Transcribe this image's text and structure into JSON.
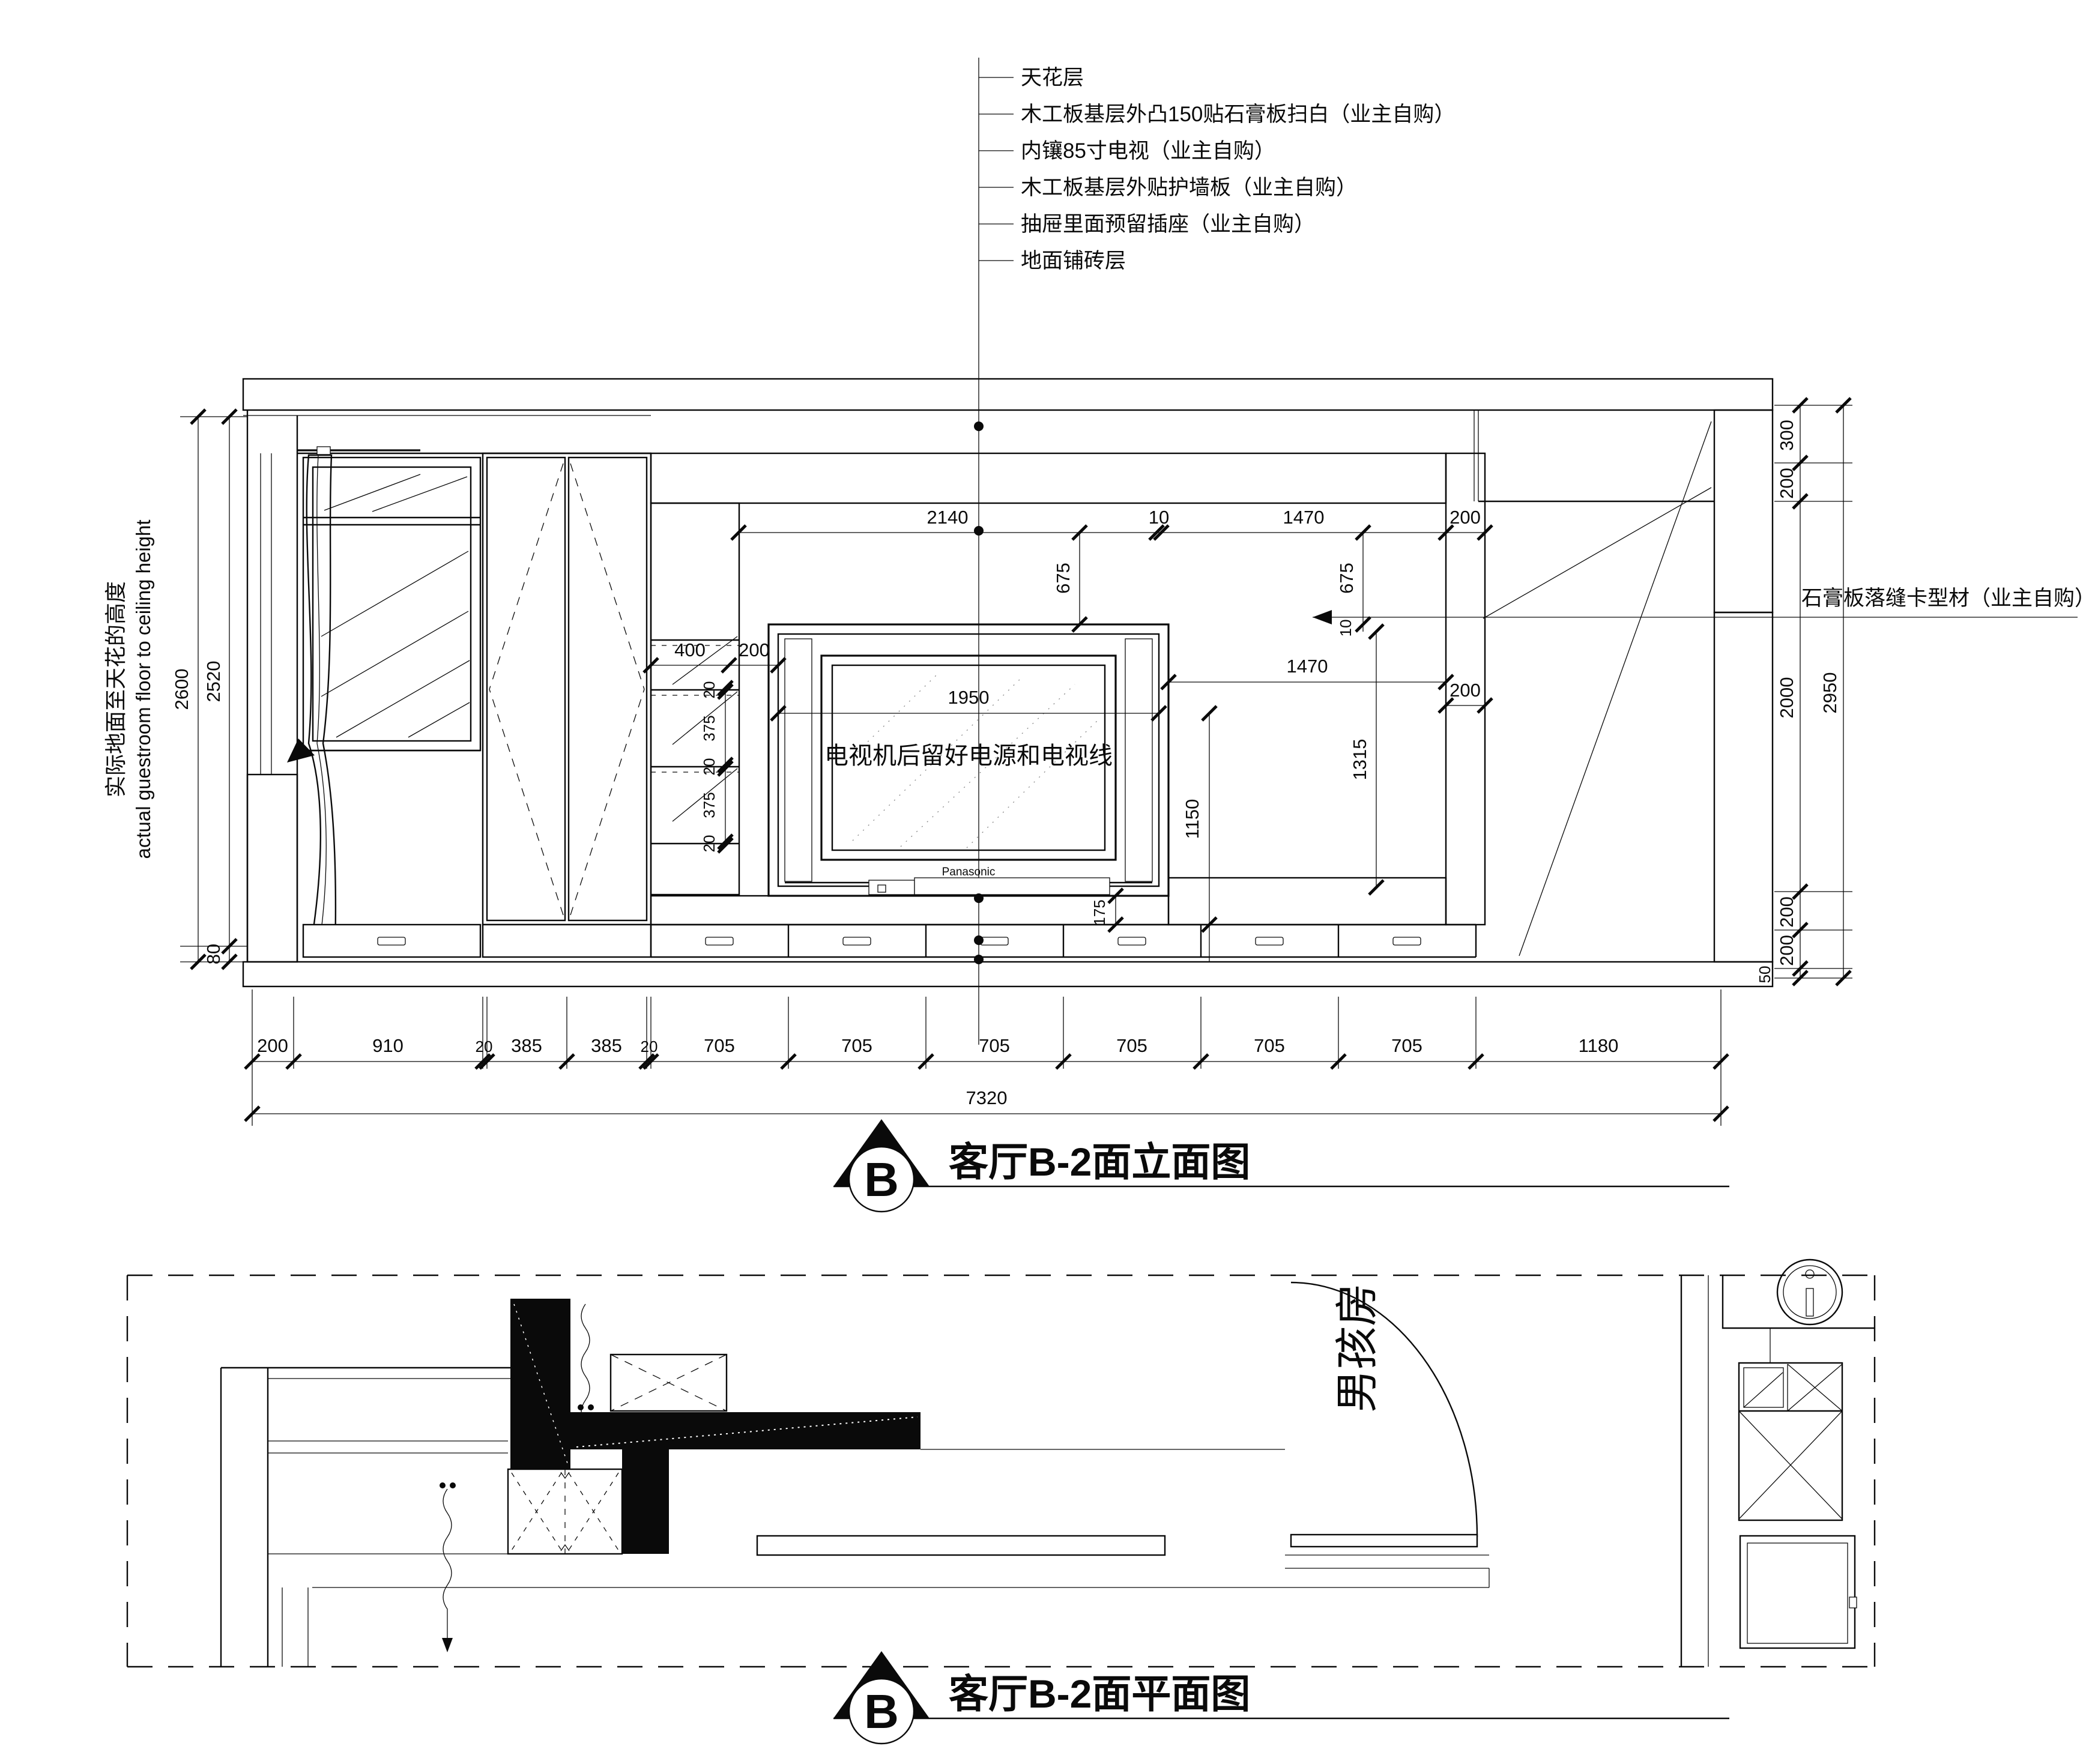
{
  "callouts": {
    "items": [
      "天花层",
      "木工板基层外凸150贴石膏板扫白（业主自购）",
      "内镶85寸电视（业主自购）",
      "木工板基层外贴护墙板（业主自购）",
      "抽屉里面预留插座（业主自购）",
      "地面铺砖层"
    ]
  },
  "right_callout": "石膏板落缝卡型材（业主自购）",
  "side_note": {
    "cn": "实际地面至天花的高度",
    "en": "actual guestroom floor to ceiling height"
  },
  "tv": {
    "note": "电视机后留好电源和电视线",
    "brand": "Panasonic"
  },
  "room_label": "男孩房",
  "titles": {
    "elevation": "客厅B-2面立面图",
    "plan": "客厅B-2面平面图",
    "marker": "B"
  },
  "dims": {
    "left_total": "2600",
    "left_inner": "2520",
    "left_base": "80",
    "right_chain": [
      "300",
      "200",
      "2000",
      "200",
      "200",
      "50"
    ],
    "right_total": "2950",
    "top_row": [
      "2140",
      "10",
      "1470",
      "200"
    ],
    "shelf_row": [
      "400",
      "200"
    ],
    "shelf_col": [
      "20",
      "375",
      "20",
      "375",
      "20"
    ],
    "tv_width": "1950",
    "tv_center": "1150",
    "niche_right_h": "1470",
    "niche_right_v": "1315",
    "col_width": "200",
    "groove": "10",
    "upper_left": "675",
    "upper_right": "675",
    "base_gap": "175",
    "bottom_chain": [
      "200",
      "910",
      "20",
      "385",
      "385",
      "20",
      "705",
      "705",
      "705",
      "705",
      "705",
      "705",
      "1180"
    ],
    "bottom_total": "7320"
  }
}
